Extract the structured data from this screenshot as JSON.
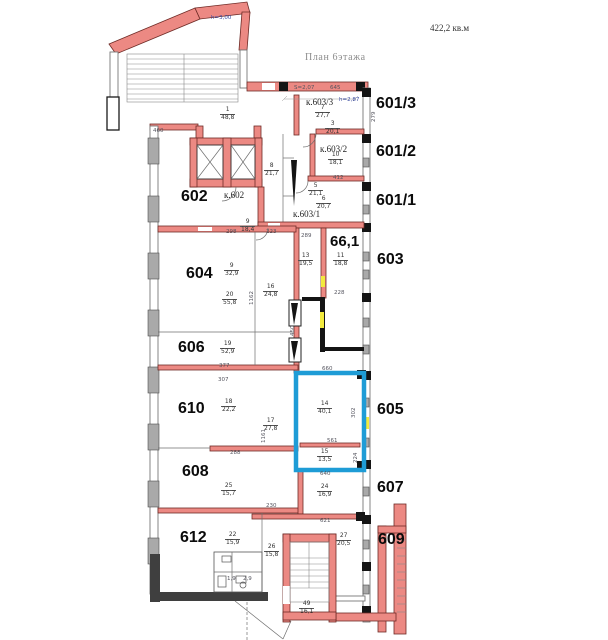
{
  "title": {
    "plan": "План 6этажа",
    "area": "422,2 кв.м"
  },
  "palette": {
    "wall": "#ec8983",
    "wall_stroke": "#6e2b26",
    "highlight": "#1e9cd6",
    "yellow": "#f2ea3e",
    "black_wall": "#141414",
    "blue_note": "#3a4ba0"
  },
  "room_numbers": [
    {
      "t": "601/3",
      "x": 376,
      "y": 95
    },
    {
      "t": "601/2",
      "x": 376,
      "y": 143
    },
    {
      "t": "601/1",
      "x": 376,
      "y": 192
    },
    {
      "t": "603",
      "x": 377,
      "y": 251
    },
    {
      "t": "605",
      "x": 377,
      "y": 401
    },
    {
      "t": "607",
      "x": 377,
      "y": 479
    },
    {
      "t": "609",
      "x": 378,
      "y": 531
    },
    {
      "t": "602",
      "x": 181,
      "y": 188
    },
    {
      "t": "604",
      "x": 186,
      "y": 265
    },
    {
      "t": "606",
      "x": 178,
      "y": 339
    },
    {
      "t": "610",
      "x": 178,
      "y": 400
    },
    {
      "t": "608",
      "x": 182,
      "y": 463
    },
    {
      "t": "612",
      "x": 180,
      "y": 529
    },
    {
      "t": "66,1",
      "x": 330,
      "y": 233,
      "s": 15
    }
  ],
  "unit_rooms": [
    {
      "t": "к.603/3",
      "x": 306,
      "y": 97
    },
    {
      "t": "к.603/2",
      "x": 320,
      "y": 144
    },
    {
      "t": "к.603/1",
      "x": 293,
      "y": 209
    },
    {
      "t": "к.602",
      "x": 224,
      "y": 190
    }
  ],
  "fractions": [
    {
      "n": "1",
      "d": "48,8",
      "x": 220,
      "y": 107
    },
    {
      "n": "9",
      "d": "18,4",
      "x": 240,
      "y": 219
    },
    {
      "n": "8",
      "d": "21,7",
      "x": 264,
      "y": 163
    },
    {
      "n": "7",
      "d": "27,7",
      "x": 315,
      "y": 105
    },
    {
      "n": "3",
      "d": "20,1",
      "x": 325,
      "y": 121
    },
    {
      "n": "10",
      "d": "18,1",
      "x": 328,
      "y": 152
    },
    {
      "n": "5",
      "d": "21,1",
      "x": 308,
      "y": 183
    },
    {
      "n": "6",
      "d": "20,7",
      "x": 316,
      "y": 196
    },
    {
      "n": "13",
      "d": "19,5",
      "x": 298,
      "y": 253
    },
    {
      "n": "11",
      "d": "18,8",
      "x": 333,
      "y": 253
    },
    {
      "n": "9",
      "d": "32,9",
      "x": 224,
      "y": 263
    },
    {
      "n": "20",
      "d": "55,8",
      "x": 222,
      "y": 292
    },
    {
      "n": "16",
      "d": "24,8",
      "x": 263,
      "y": 284
    },
    {
      "n": "19",
      "d": "52,9",
      "x": 220,
      "y": 341
    },
    {
      "n": "18",
      "d": "22,2",
      "x": 221,
      "y": 399
    },
    {
      "n": "17",
      "d": "27,8",
      "x": 263,
      "y": 418
    },
    {
      "n": "14",
      "d": "40,1",
      "x": 317,
      "y": 401
    },
    {
      "n": "15",
      "d": "13,5",
      "x": 317,
      "y": 449
    },
    {
      "n": "25",
      "d": "15,7",
      "x": 221,
      "y": 483
    },
    {
      "n": "24",
      "d": "16,9",
      "x": 317,
      "y": 484
    },
    {
      "n": "22",
      "d": "15,9",
      "x": 225,
      "y": 532
    },
    {
      "n": "26",
      "d": "15,8",
      "x": 264,
      "y": 544
    },
    {
      "n": "27",
      "d": "20,5",
      "x": 336,
      "y": 533
    },
    {
      "n": "49",
      "d": "16,1",
      "x": 299,
      "y": 601
    }
  ],
  "dims": [
    {
      "t": "645",
      "x": 330,
      "y": 85
    },
    {
      "t": "S=2,07",
      "x": 294,
      "y": 85
    },
    {
      "t": "h=2,87",
      "x": 339,
      "y": 97,
      "blue": true
    },
    {
      "t": "h=3,00",
      "x": 211,
      "y": 15,
      "blue": true
    },
    {
      "t": "460",
      "x": 153,
      "y": 128
    },
    {
      "t": "412",
      "x": 333,
      "y": 175
    },
    {
      "t": "289",
      "x": 301,
      "y": 233
    },
    {
      "t": "223",
      "x": 266,
      "y": 229
    },
    {
      "t": "298",
      "x": 226,
      "y": 229
    },
    {
      "t": "377",
      "x": 219,
      "y": 363
    },
    {
      "t": "307",
      "x": 218,
      "y": 377
    },
    {
      "t": "288",
      "x": 230,
      "y": 450
    },
    {
      "t": "660",
      "x": 322,
      "y": 366
    },
    {
      "t": "640",
      "x": 320,
      "y": 471
    },
    {
      "t": "561",
      "x": 327,
      "y": 438
    },
    {
      "t": "621",
      "x": 320,
      "y": 518
    },
    {
      "t": "228",
      "x": 334,
      "y": 290
    },
    {
      "t": "230",
      "x": 266,
      "y": 503
    },
    {
      "t": "2,9",
      "x": 243,
      "y": 576
    },
    {
      "t": "1,9",
      "x": 227,
      "y": 576
    },
    {
      "t": "279",
      "x": 371,
      "y": 122,
      "v": true
    },
    {
      "t": "1162",
      "x": 249,
      "y": 305,
      "v": true
    },
    {
      "t": "1161",
      "x": 261,
      "y": 443,
      "v": true
    },
    {
      "t": "450",
      "x": 290,
      "y": 336,
      "v": true
    },
    {
      "t": "302",
      "x": 351,
      "y": 418,
      "v": true
    },
    {
      "t": "224",
      "x": 353,
      "y": 463,
      "v": true
    }
  ]
}
